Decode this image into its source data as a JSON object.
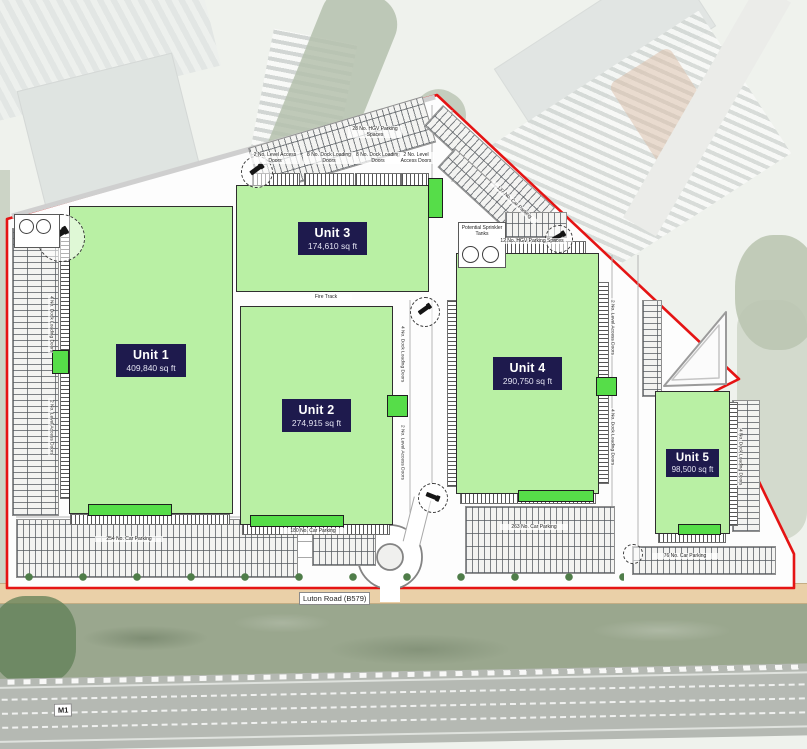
{
  "site": {
    "units": [
      {
        "name": "Unit 1",
        "area": "409,840 sq ft"
      },
      {
        "name": "Unit 2",
        "area": "274,915 sq ft"
      },
      {
        "name": "Unit 3",
        "area": "174,610 sq ft"
      },
      {
        "name": "Unit 4",
        "area": "290,750 sq ft"
      },
      {
        "name": "Unit 5",
        "area": "98,500 sq ft"
      }
    ],
    "colors": {
      "boundary_red": "#e51414",
      "unit_green": "#b9f0a4",
      "accent_green": "#56dd49",
      "label_navy": "#1e1a4d"
    }
  },
  "labels": {
    "level_access": "2 No. Level Access Doors",
    "dock_8": "8 No. Dock Loading Doors",
    "dock_4": "4 No. Dock Loading Doors",
    "hgv_28": "28 No. HGV Parking Spaces",
    "hgv_12": "12 No. HGV Parking Spaces",
    "sprinkler": "Potential Sprinkler Tanks",
    "fire_track": "Fire Track",
    "car_254": "254 No. Car Parking",
    "car_180": "180 No. Car Parking",
    "car_263": "263 No. Car Parking",
    "car_137": "137 No. Car Parking",
    "car_76": "76 No. Car Parking"
  },
  "roads": {
    "luton_road": "Luton Road (B579)",
    "motorway": "M1"
  }
}
